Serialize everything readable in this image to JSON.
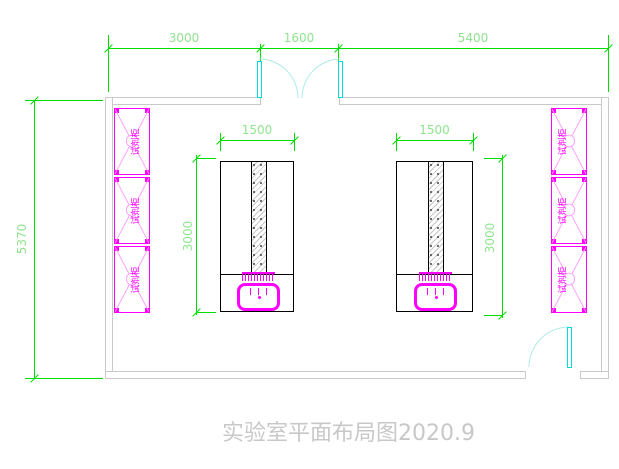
{
  "drawing": {
    "title": "实验室平面布局图2020.9",
    "room": {
      "width_labels": [
        "3000",
        "1600",
        "5400"
      ],
      "height_label": "5370"
    },
    "benches": [
      {
        "width_label": "1500",
        "height_label": "3000"
      },
      {
        "width_label": "1500",
        "height_label": "3000"
      }
    ],
    "cabinet_label": "试剂柜",
    "colors": {
      "dimension_line": "#00dd00",
      "dimension_text": "#8fe58f",
      "cabinet": "#ff00ff",
      "cabinet_light": "#ff9cff",
      "wall": "#c9c9c9",
      "door": "#00dcdc",
      "door_arc": "#aeeaea",
      "bench_outline": "#000000",
      "title_text": "#c8c8c8"
    }
  }
}
